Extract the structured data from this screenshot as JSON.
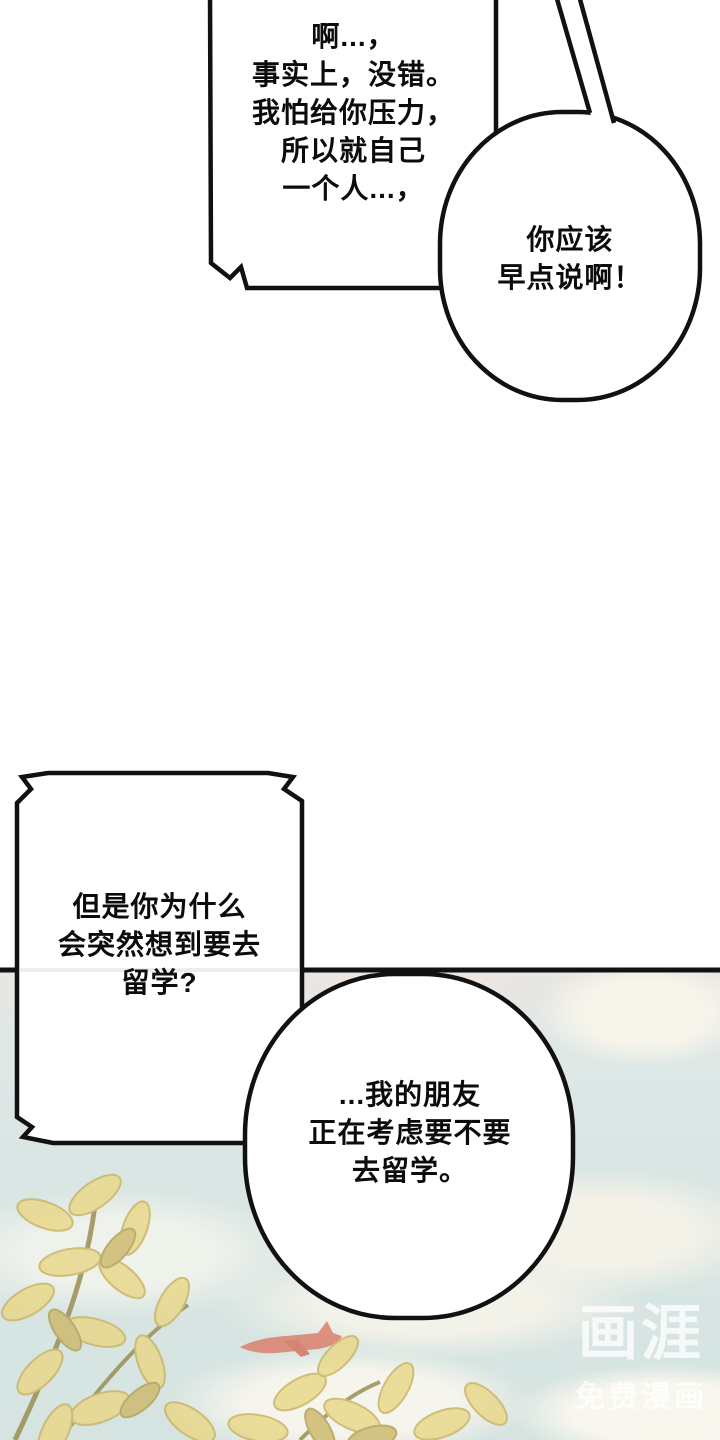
{
  "page": {
    "kind": "comic-panel",
    "background_color": "#ffffff",
    "line_color": "#111111",
    "sky_color": "#d9e6e4",
    "cloud_color": "#f7f4ea",
    "haze_color": "#ece7e2",
    "foliage_color": "#e9d88b",
    "foliage_dark_color": "#c9b566",
    "airplane_color": "#db7c67",
    "watermark_color": "#ffffff"
  },
  "bubbles": {
    "rect1": {
      "lines": [
        "啊...，",
        "事实上，没错。",
        "我怕给你压力，",
        "所以就自己",
        "一个人...，"
      ]
    },
    "round1": {
      "lines": [
        "你应该",
        "早点说啊！"
      ]
    },
    "rect2": {
      "lines": [
        "但是你为什么",
        "会突然想到要去",
        "留学?"
      ]
    },
    "round2": {
      "lines": [
        "...我的朋友",
        "正在考虑要不要",
        "去留学。"
      ]
    }
  },
  "watermark": {
    "logo": "画涯",
    "tagline": "免费漫画"
  }
}
